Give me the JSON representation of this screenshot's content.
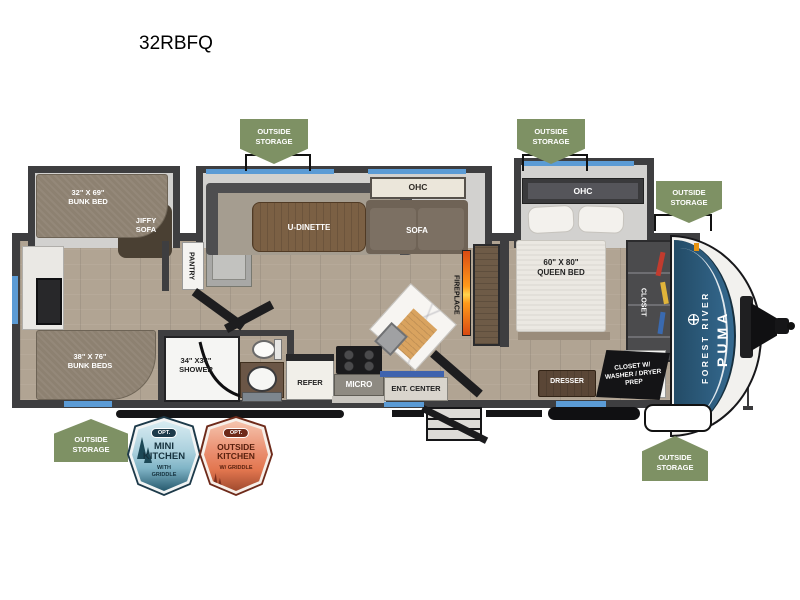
{
  "title": "32RBFQ",
  "badges": {
    "outside_storage": "OUTSIDE\nSTORAGE",
    "mini_kitchen": {
      "opt": "OPT.",
      "name": "MINI\nKITCHEN",
      "sub": "WITH\nGRIDDLE"
    },
    "outside_kitchen": {
      "opt": "OPT.",
      "name": "OUTSIDE\nKITCHEN",
      "sub": "W/ GRIDDLE"
    }
  },
  "labels": {
    "bunk_bed_32": "32\" X 69\"\nBUNK BED",
    "jiffy_sofa": "JIFFY\nSOFA",
    "bunk_beds_38": "38\" X 76\"\nBUNK BEDS",
    "pantry": "PANTRY",
    "u_dinette": "U-DINETTE",
    "ohc_living": "OHC",
    "sofa": "SOFA",
    "ohc_bedroom": "OHC",
    "queen_bed": "60\" X 80\"\nQUEEN BED",
    "closet": "CLOSET",
    "shower": "34\" X34\"\nSHOWER",
    "refer": "REFER",
    "micro": "MICRO",
    "ent_center": "ENT. CENTER",
    "fireplace": "FIREPLACE",
    "dresser": "DRESSER",
    "washer_dryer": "CLOSET W/\nWASHER / DRYER\nPREP"
  },
  "brand": {
    "line1": "FOREST RIVER",
    "line2": "PUMA"
  },
  "colors": {
    "storage_badge_green": "#7e9164",
    "wall_dark": "#3e3e40",
    "floor_tan": "#b1a493",
    "window_blue": "#5b9bd5",
    "front_cap_blue": "#2c5878",
    "mini_kitchen_badge": "#a9cfdc",
    "outside_kitchen_badge": "#e2764f",
    "fireplace_glow": "#ff9a1a"
  }
}
